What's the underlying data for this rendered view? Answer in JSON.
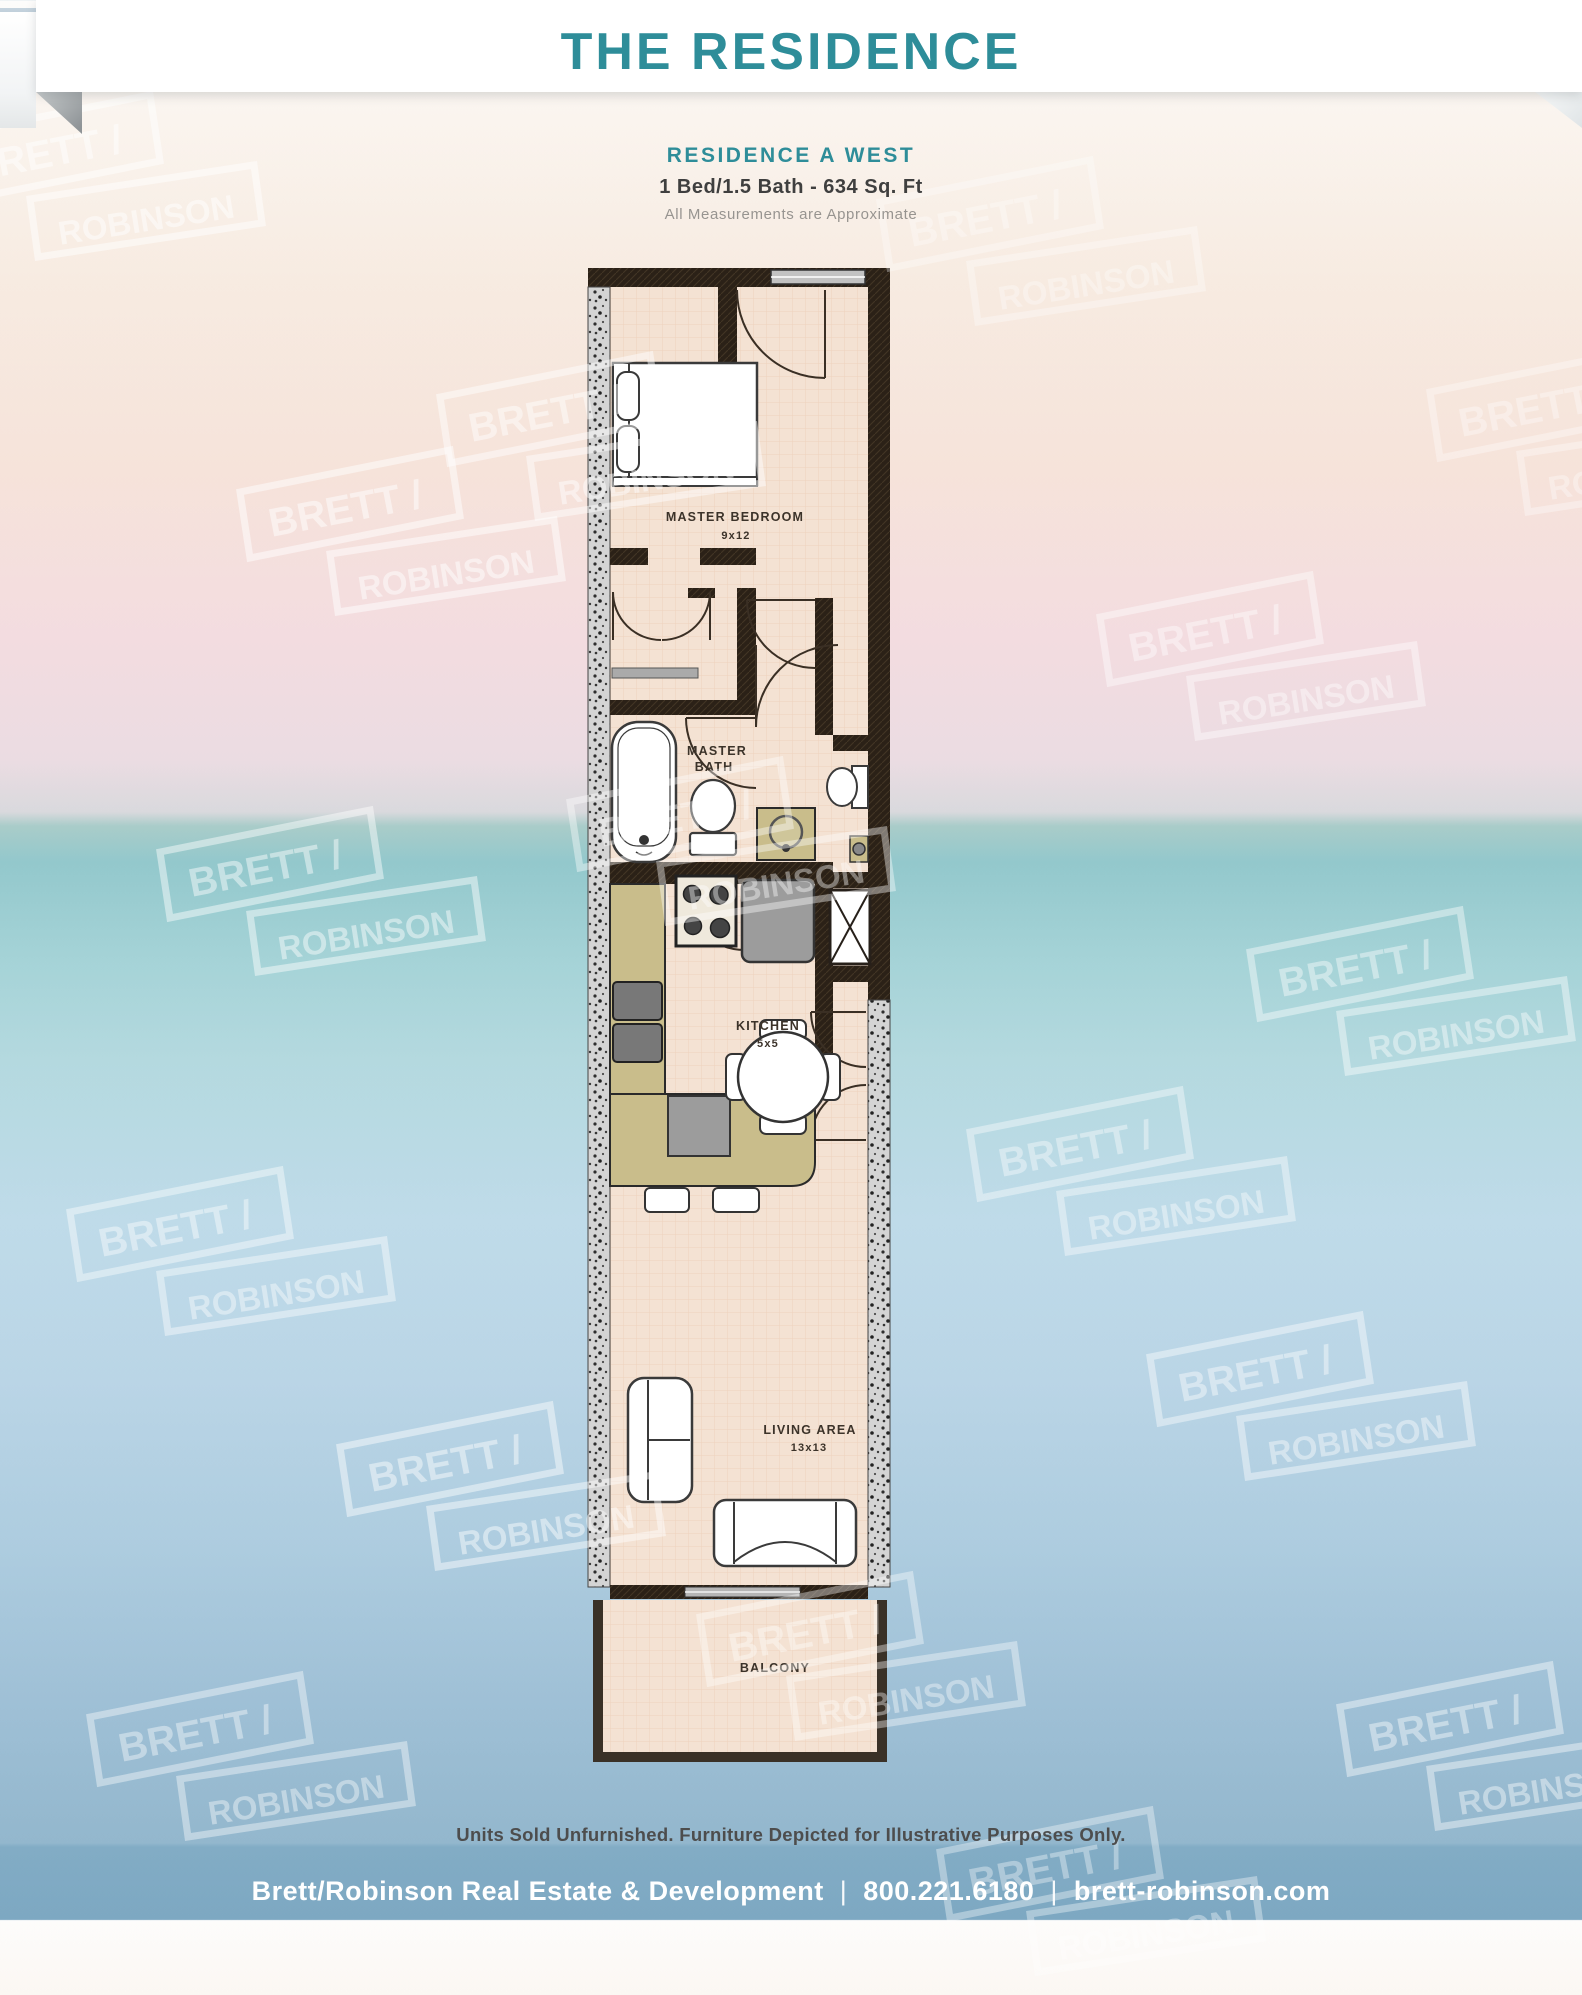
{
  "header": {
    "banner_title": "THE RESIDENCE",
    "subtitle": "RESIDENCE  A WEST",
    "specs": "1 Bed/1.5 Bath - 634 Sq. Ft",
    "disclaimer": "All Measurements are Approximate"
  },
  "floorplan": {
    "master_bedroom_label": "MASTER BEDROOM",
    "master_bedroom_dims": "9x12",
    "master_bath_label_1": "MASTER",
    "master_bath_label_2": "BATH",
    "kitchen_label": "KITCHEN",
    "kitchen_dims": "5x5",
    "living_label": "LIVING AREA",
    "living_dims": "13x13",
    "balcony_label": "BALCONY"
  },
  "footnote": "Units Sold Unfurnished. Furniture Depicted for Illustrative Purposes Only.",
  "footer": {
    "company": "Brett/Robinson Real Estate & Development",
    "phone": "800.221.6180",
    "website": "brett-robinson.com",
    "separator": "|"
  },
  "watermark": {
    "line1": "BRETT /",
    "line2": "ROBINSON",
    "positions": [
      {
        "x": -70,
        "y": 75,
        "o": 0.5
      },
      {
        "x": 870,
        "y": 140,
        "o": 0.32
      },
      {
        "x": 1420,
        "y": 330,
        "o": 0.34
      },
      {
        "x": 430,
        "y": 335,
        "o": 0.48
      },
      {
        "x": 230,
        "y": 430,
        "o": 0.5
      },
      {
        "x": 1090,
        "y": 555,
        "o": 0.42
      },
      {
        "x": 560,
        "y": 740,
        "o": 0.4
      },
      {
        "x": 150,
        "y": 790,
        "o": 0.46
      },
      {
        "x": 1240,
        "y": 890,
        "o": 0.42
      },
      {
        "x": 60,
        "y": 1150,
        "o": 0.42
      },
      {
        "x": 960,
        "y": 1070,
        "o": 0.4
      },
      {
        "x": 330,
        "y": 1385,
        "o": 0.46
      },
      {
        "x": 1140,
        "y": 1295,
        "o": 0.42
      },
      {
        "x": 690,
        "y": 1555,
        "o": 0.38
      },
      {
        "x": 80,
        "y": 1655,
        "o": 0.4
      },
      {
        "x": 1330,
        "y": 1645,
        "o": 0.42
      },
      {
        "x": 930,
        "y": 1790,
        "o": 0.36
      }
    ]
  },
  "colors": {
    "accent_teal": "#2e8d99",
    "footer_band_blue": "#82acc5",
    "wall_dark": "#2b2117",
    "floor_peach": "#f4e2d3",
    "counter_olive": "#c9bd8b",
    "watermark_white": "#ffffff"
  }
}
